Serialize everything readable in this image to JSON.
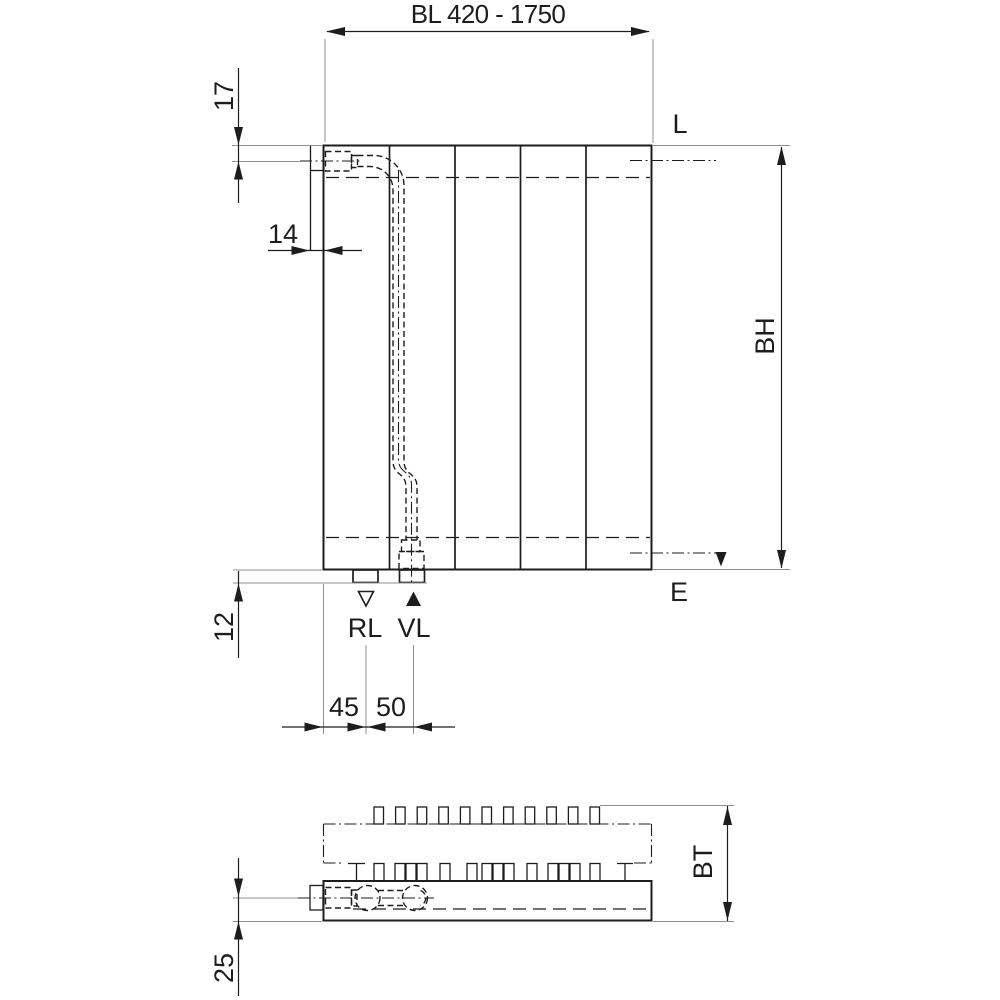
{
  "front_view": {
    "length_dim": "BL 420 - 1750",
    "top_inset_dim": "17",
    "side_inset_dim": "14",
    "vent_label": "L",
    "height_dim": "BH",
    "drain_label": "E",
    "bottom_inset_dim": "12",
    "return_label": "RL",
    "supply_label": "VL",
    "return_offset_dim": "45",
    "supply_spacing_dim": "50"
  },
  "plan_view": {
    "depth_dim": "BT",
    "center_offset_dim": "25"
  },
  "colors": {
    "line": "#1d1d1b",
    "dimension_line": "#1d1d1b",
    "extension_line": "#8f8f8f",
    "background": "#ffffff"
  }
}
